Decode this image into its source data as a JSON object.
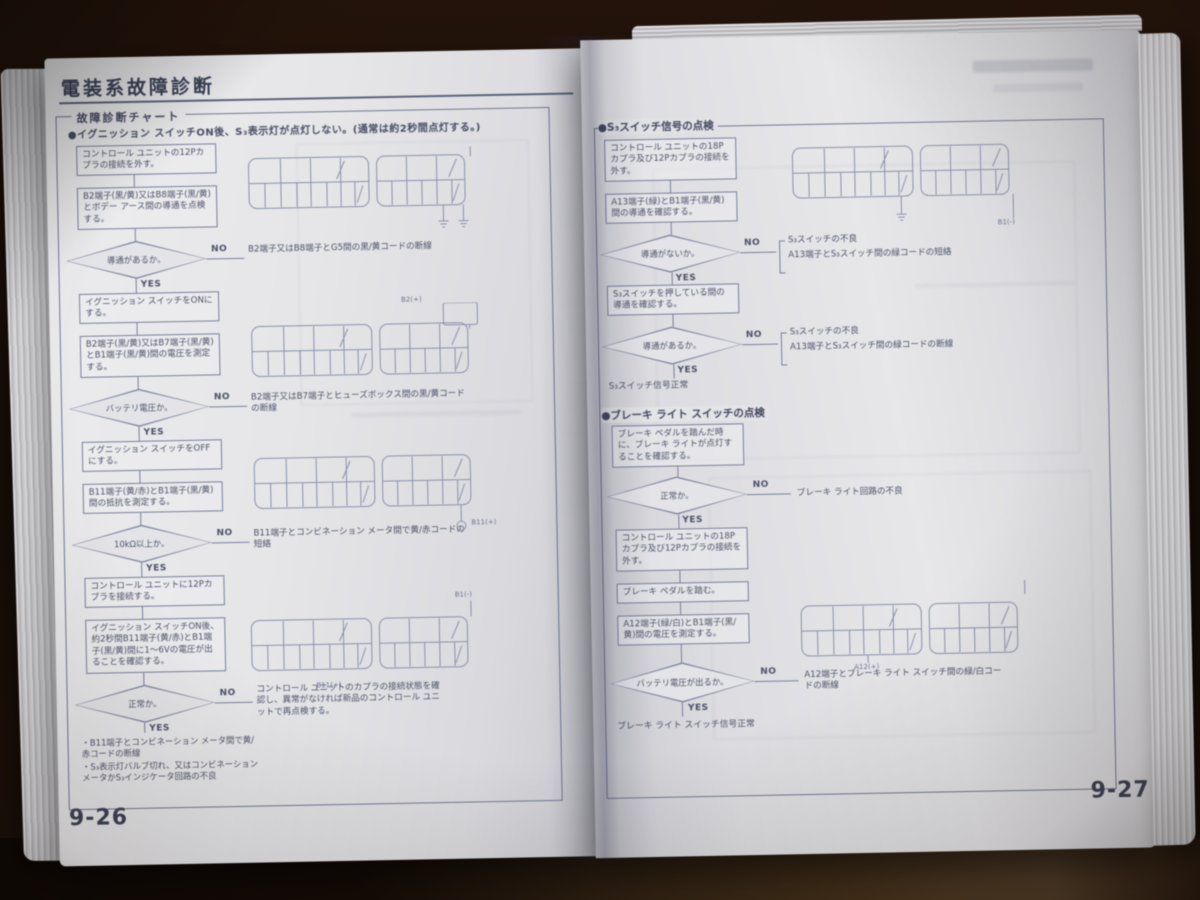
{
  "colors": {
    "paper": "#e6e6e9",
    "ink": "#4b5068",
    "line": "#787e9c",
    "background": "#1c0f08"
  },
  "left": {
    "page_number": "9-26",
    "title": "電装系故障診断",
    "chart_label": "故障診断チャート",
    "condition": "●イグニッション スイッチON後、S₃表示灯が点灯しない。(通常は約2秒間点灯する。)",
    "yes": "YES",
    "no": "NO",
    "b1": "コントロール ユニットの12Pカプラの接続を外す。",
    "b2": "B2端子(黒/黄)又はB8端子(黒/黄)とボデー アース間の導通を点検する。",
    "d1": "導通があるか。",
    "a1": "B2端子又はB8端子とG5間の黒/黄コードの断線",
    "b3": "イグニッション スイッチをONにする。",
    "b4": "B2端子(黒/黄)又はB7端子(黒/黄)とB1端子(黒/黄)間の電圧を測定する。",
    "d2": "バッテリ電圧か。",
    "a2": "B2端子又はB7端子とヒューズボックス間の黒/黄コードの断線",
    "b5": "イグニッション スイッチをOFFにする。",
    "b6": "B11端子(黄/赤)とB1端子(黒/黄)間の抵抗を測定する。",
    "d3": "10kΩ以上か。",
    "a3": "B11端子とコンビネーション メータ間で黄/赤コードの短絡",
    "b7": "コントロール ユニットに12Pカプラを接続する。",
    "b8": "イグニッション スイッチON後、約2秒間B11端子(黄/赤)とB1端子(黒/黄)間に1〜6Vの電圧が出ることを確認する。",
    "d4": "正常か。",
    "a4": "コントロール ユニットのカプラの接続状態を確認し、異常がなければ新品のコントロール ユニットで再点検する。",
    "note1": "・B11端子とコンビネーション メータ間で黄/赤コードの断線",
    "note2": "・S₃表示灯バルブ切れ、又はコンビネーション メータかS₃インジケータ回路の不良",
    "conn_labels": {
      "g2": "B2(+)",
      "g3": "B11(+)",
      "g4a": "B1(-)",
      "g4b": "B11(+)"
    }
  },
  "right": {
    "page_number": "9-27",
    "yes": "YES",
    "no": "NO",
    "s1_title": "●S₃スイッチ信号の点検",
    "s1_b1": "コントロール ユニットの18Pカプラ及び12Pカプラの接続を外す。",
    "s1_b2": "A13端子(緑)とB1端子(黒/黄)間の導通を確認する。",
    "s1_d1": "導通がないか。",
    "s1_a1a": "S₃スイッチの不良",
    "s1_a1b": "A13端子とS₃スイッチ間の緑コードの短絡",
    "s1_b3": "S₃スイッチを押している間の導通を確認する。",
    "s1_d2": "導通があるか。",
    "s1_a2a": "S₃スイッチの不良",
    "s1_a2b": "A13端子とS₃スイッチ間の緑コードの断線",
    "s1_end": "S₃スイッチ信号正常",
    "s2_title": "●ブレーキ ライト スイッチの点検",
    "s2_b1": "ブレーキ ペダルを踏んだ時に、ブレーキ ライトが点灯することを確認する。",
    "s2_d1": "正常か。",
    "s2_a1": "ブレーキ ライト回路の不良",
    "s2_b2": "コントロール ユニットの18Pカプラ及び12Pカプラの接続を外す。",
    "s2_b3": "ブレーキ ペダルを踏む。",
    "s2_b4": "A12端子(緑/白)とB1端子(黒/黄)間の電圧を測定する。",
    "s2_d2": "バッテリ電圧が出るか。",
    "s2_a2": "A12端子とブレーキ ライト スイッチ間の緑/白コードの断線",
    "s2_end": "ブレーキ ライト スイッチ信号正常",
    "conn_labels": {
      "rg1": "B1(-)",
      "rg2": "A12(+)"
    }
  }
}
